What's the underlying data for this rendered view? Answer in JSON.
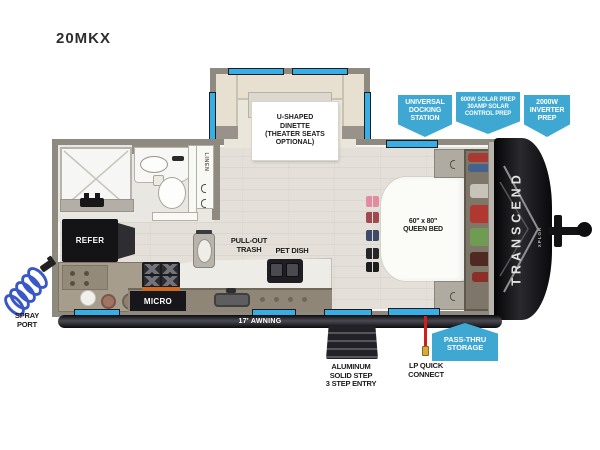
{
  "title": "20MKX",
  "branding": {
    "name": "TRANSCEND",
    "series": "XPLOR"
  },
  "callouts": {
    "universal_docking": "UNIVERSAL\nDOCKING\nSTATION",
    "solar_prep": "600W SOLAR PREP\n30AMP SOLAR\nCONTROL PREP",
    "inverter_prep": "2000W\nINVERTER\nPREP",
    "pass_thru_storage": "PASS-THRU\nSTORAGE"
  },
  "interior": {
    "dinette": "U-SHAPED\nDINETTE\n(THEATER SEATS\nOPTIONAL)",
    "queen_bed": "60\" x 80\"\nQUEEN BED",
    "refrigerator": "REFER",
    "microwave": "MICRO",
    "pull_out_trash": "PULL-OUT\nTRASH",
    "pet_dish": "PET DISH",
    "linen_closet": "LINEN"
  },
  "exterior": {
    "spray_port": "SPRAY\nPORT",
    "awning": "17' AWNING",
    "entry_step": "ALUMINUM\nSOLID STEP\n3 STEP ENTRY",
    "lp_quick_connect": "LP QUICK\nCONNECT"
  },
  "icons": {
    "spray_port_icon": "coiled-hose-sprayer",
    "trash_can_icon": "trash-can",
    "pet_dish_icon": "double-bowl-feeder",
    "stove_icon": "four-burner-cooktop",
    "shower_head_icon": "shower-head",
    "hitch_icon": "trailer-tongue-coupler",
    "steps_icon": "triple-entry-step"
  },
  "colors": {
    "callout_blue": "#3ea7d2",
    "window_blue": "#38aee6",
    "wall_gray": "#8f8a80",
    "floor_tan": "#e4e0d9",
    "lp_line_red": "#cf1f1a",
    "spray_coil_blue": "#3a57c8",
    "stove_accent_orange": "#d2691e"
  }
}
